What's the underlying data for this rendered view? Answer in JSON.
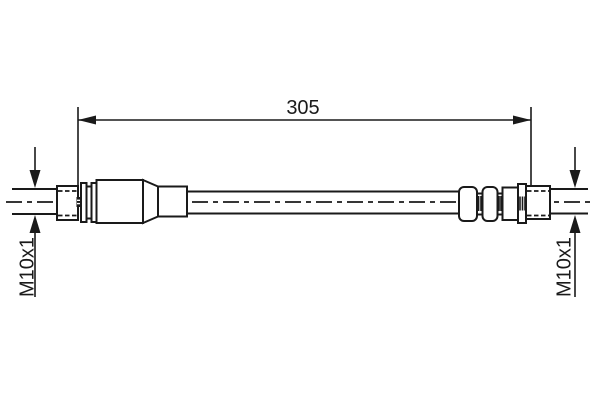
{
  "diagram": {
    "kind": "brake-hose-technical-drawing",
    "dimension": {
      "label": "305"
    },
    "left_fitting": {
      "thread_label": "M10x1"
    },
    "right_fitting": {
      "thread_label": "M10x1"
    },
    "colors": {
      "line": "#1a1a1a",
      "background": "#ffffff"
    }
  }
}
